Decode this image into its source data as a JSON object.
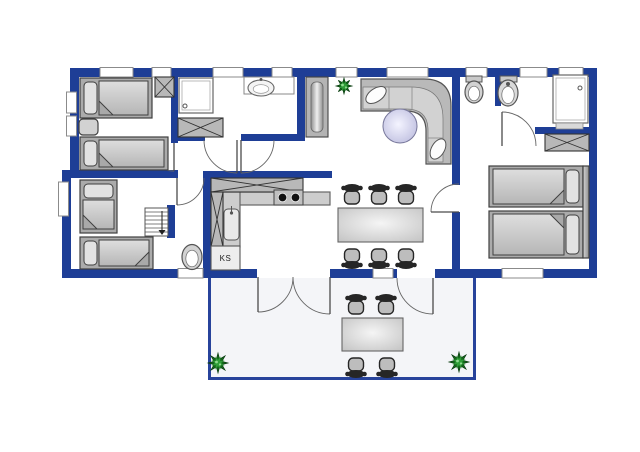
{
  "labels": {
    "fridge": "KS"
  },
  "palette": {
    "wall": "#1e3e96",
    "terraceWall": "#27439b",
    "line": "#3f3f3f",
    "furn": "#ababab",
    "furnLight": "#d2d2d2",
    "pillow": "#e2e2e2",
    "fold": "#a9a9a9",
    "chairDark": "#262626",
    "chairSeat": "#bdbdbd",
    "white": "#ffffff",
    "windowStroke": "#8b8b8b",
    "plantDark": "#14691c",
    "plantMid": "#2f9e38",
    "plantLight": "#8fd98f",
    "terraceFloor": "#f4f5f8",
    "counter": "#cdcdcd",
    "fixture": "#d9d9d9"
  },
  "floor_plan": {
    "canvas": {
      "w": 640,
      "h": 452
    },
    "house_floor": [
      62,
      68,
      535,
      210
    ],
    "walls": [
      {
        "n": "top-wall",
        "x": 70,
        "y": 68,
        "w": 527,
        "h": 9
      },
      {
        "n": "bottom-wall-left",
        "x": 62,
        "y": 269,
        "w": 195,
        "h": 9
      },
      {
        "n": "bottom-wall-mid",
        "x": 330,
        "y": 269,
        "w": 67,
        "h": 9
      },
      {
        "n": "bottom-wall-right",
        "x": 435,
        "y": 269,
        "w": 162,
        "h": 9
      },
      {
        "n": "left-wall-upper",
        "x": 70,
        "y": 68,
        "w": 9,
        "h": 108
      },
      {
        "n": "left-wall-lower",
        "x": 62,
        "y": 170,
        "w": 9,
        "h": 108
      },
      {
        "n": "right-wall",
        "x": 589,
        "y": 68,
        "w": 8,
        "h": 210
      },
      {
        "n": "bedroom1-bedroom2-wall",
        "x": 62,
        "y": 170,
        "w": 116,
        "h": 8
      },
      {
        "n": "bedroom1-hall-wall",
        "x": 171,
        "y": 68,
        "w": 7,
        "h": 75
      },
      {
        "n": "bathroom1-hall-wall-left",
        "x": 171,
        "y": 134,
        "w": 34,
        "h": 7
      },
      {
        "n": "bathroom1-hall-wall-right",
        "x": 241,
        "y": 134,
        "w": 64,
        "h": 7
      },
      {
        "n": "bathroom1-living-wall",
        "x": 297,
        "y": 68,
        "w": 8,
        "h": 73
      },
      {
        "n": "kitchen-top-wall",
        "x": 203,
        "y": 171,
        "w": 129,
        "h": 7
      },
      {
        "n": "corridor-kitchen-wall",
        "x": 203,
        "y": 171,
        "w": 8,
        "h": 107
      },
      {
        "n": "stairs-stub-wall",
        "x": 167,
        "y": 205,
        "w": 8,
        "h": 33
      },
      {
        "n": "living-bathroom2-wall",
        "x": 452,
        "y": 68,
        "w": 8,
        "h": 117
      },
      {
        "n": "dining-bedroom3-wall",
        "x": 452,
        "y": 212,
        "w": 8,
        "h": 66
      },
      {
        "n": "bathroom2-stub-wall",
        "x": 495,
        "y": 68,
        "w": 6,
        "h": 38
      },
      {
        "n": "bathroom2-bedroom3-wall",
        "x": 535,
        "y": 127,
        "w": 55,
        "h": 7
      }
    ],
    "windows": [
      {
        "n": "window-top-1",
        "x": 100,
        "y": 67.5,
        "w": 33,
        "h": 9.5
      },
      {
        "n": "window-top-2",
        "x": 152,
        "y": 67.5,
        "w": 19,
        "h": 9.5
      },
      {
        "n": "window-top-3",
        "x": 213,
        "y": 67.5,
        "w": 30,
        "h": 9.5
      },
      {
        "n": "window-top-4",
        "x": 272,
        "y": 67.5,
        "w": 20,
        "h": 9.5
      },
      {
        "n": "window-top-5",
        "x": 336,
        "y": 67.5,
        "w": 21,
        "h": 9.5
      },
      {
        "n": "window-top-6",
        "x": 387,
        "y": 67.5,
        "w": 41,
        "h": 9.5
      },
      {
        "n": "window-top-7",
        "x": 466,
        "y": 67.5,
        "w": 21,
        "h": 9.5
      },
      {
        "n": "window-top-8",
        "x": 520,
        "y": 67.5,
        "w": 27,
        "h": 9.5
      },
      {
        "n": "window-top-9",
        "x": 559,
        "y": 67.5,
        "w": 24,
        "h": 9.5
      },
      {
        "n": "window-left-1",
        "x": 66.5,
        "y": 92,
        "w": 10,
        "h": 21
      },
      {
        "n": "window-left-2",
        "x": 66.5,
        "y": 116,
        "w": 10,
        "h": 20
      },
      {
        "n": "window-left-3",
        "x": 58.5,
        "y": 182,
        "w": 10,
        "h": 34
      },
      {
        "n": "window-bottom-1",
        "x": 178,
        "y": 268.5,
        "w": 25,
        "h": 9.5
      },
      {
        "n": "window-bottom-2",
        "x": 373,
        "y": 268.5,
        "w": 20,
        "h": 9.5
      },
      {
        "n": "window-bottom-3",
        "x": 502,
        "y": 268.5,
        "w": 41,
        "h": 9.5
      }
    ],
    "doors": [
      {
        "n": "bedroom1-door",
        "hx": 174,
        "hy": 143,
        "r": 28,
        "a0": 180,
        "a1": 90
      },
      {
        "n": "bedroom2-door",
        "hx": 177,
        "hy": 178,
        "r": 27,
        "a0": 0,
        "a1": 90
      },
      {
        "n": "bathroom1-door",
        "hx": 237,
        "hy": 140,
        "r": 33,
        "a0": 180,
        "a1": 90
      },
      {
        "n": "hall-kitchen-door",
        "hx": 241,
        "hy": 140,
        "r": 33,
        "a0": 0,
        "a1": 90
      },
      {
        "n": "bedroom3-door",
        "hx": 459,
        "hy": 212,
        "r": 28,
        "a0": 270,
        "a1": 180
      },
      {
        "n": "bathroom2-door",
        "hx": 502,
        "hy": 146,
        "r": 34,
        "a0": 360,
        "a1": 270
      },
      {
        "n": "terrace-french-door-left",
        "hx": 258,
        "hy": 277,
        "r": 35,
        "a0": 0,
        "a1": 90
      },
      {
        "n": "terrace-french-door-right",
        "hx": 330,
        "hy": 277,
        "r": 37,
        "a0": 180,
        "a1": 90
      },
      {
        "n": "terrace-side-door",
        "hx": 433,
        "hy": 278,
        "r": 36,
        "a0": 180,
        "a1": 90
      }
    ],
    "terrace": {
      "floor": [
        208,
        278,
        268,
        102
      ],
      "walls": [
        [
          208,
          278,
          3,
          102
        ],
        [
          473,
          278,
          3,
          102
        ],
        [
          208,
          377,
          268,
          3
        ]
      ]
    },
    "beds": [
      {
        "n": "bedroom1-bed-upper",
        "x": 80,
        "y": 78,
        "w": 72,
        "h": 40,
        "dir": "left",
        "fold": "bl"
      },
      {
        "n": "bedroom1-bed-lower",
        "x": 80,
        "y": 137,
        "w": 88,
        "h": 33,
        "dir": "left",
        "fold": "bl"
      },
      {
        "n": "bedroom2-bed-vertical",
        "x": 80,
        "y": 180,
        "w": 37,
        "h": 53,
        "dir": "top",
        "fold": "bl"
      },
      {
        "n": "bedroom2-bed-horizontal",
        "x": 80,
        "y": 237,
        "w": 73,
        "h": 32,
        "dir": "left",
        "fold": "br"
      },
      {
        "n": "bedroom3-bed-upper",
        "x": 489,
        "y": 166,
        "w": 94,
        "h": 41,
        "dir": "right",
        "fold": "br"
      },
      {
        "n": "bedroom3-bed-lower",
        "x": 489,
        "y": 211,
        "w": 94,
        "h": 47,
        "dir": "right",
        "fold": "tr"
      }
    ],
    "counters": [
      {
        "n": "kitchen-counter-top",
        "x": 211,
        "y": 192,
        "w": 119,
        "h": 13
      },
      {
        "n": "kitchen-counter-side",
        "x": 222,
        "y": 192,
        "w": 18,
        "h": 55
      }
    ],
    "xboxes": [
      {
        "n": "bedroom1-wardrobe",
        "x": 155,
        "y": 77,
        "w": 19,
        "h": 20
      },
      {
        "n": "bathroom1-wardrobe",
        "x": 178,
        "y": 118,
        "w": 45,
        "h": 19
      },
      {
        "n": "bedroom3-wardrobe",
        "x": 545,
        "y": 134,
        "w": 44,
        "h": 17
      },
      {
        "n": "kitchen-upper-cabinet",
        "x": 211,
        "y": 178,
        "w": 92,
        "h": 14
      },
      {
        "n": "kitchen-side-cabinet",
        "x": 211,
        "y": 192,
        "w": 12,
        "h": 55
      }
    ],
    "stove": {
      "x": 274,
      "y": 190,
      "w": 29,
      "h": 15,
      "burners": [
        [
          282.5,
          197.5
        ],
        [
          295.5,
          197.5
        ]
      ],
      "burnerR": 4.3
    },
    "sink": {
      "x": 224,
      "y": 209,
      "w": 15,
      "h": 31
    },
    "fridge": {
      "x": 211,
      "y": 246,
      "w": 29,
      "h": 24
    },
    "nightstand": {
      "x": 79,
      "y": 119,
      "w": 19,
      "h": 16
    },
    "stairs": {
      "x": 145,
      "y": 208,
      "w": 23,
      "h": 28,
      "steps": 6
    },
    "headboard": {
      "x": 583,
      "y": 166,
      "w": 6,
      "h": 92
    },
    "tall_cabinet": {
      "x": 306,
      "y": 77,
      "w": 22,
      "h": 60
    },
    "sofa": {
      "base": "M361,79 L424,79 Q451,79 451,106 L451,164 L426,164 L426,131 Q426,111 406,111 L361,111 Z",
      "seat": "M363,87 L411,87 Q443,87 443,119 L443,162 L428,162 L428,130 Q428,109 406,109 L363,109 Z",
      "dividers": [
        [
          389,
          87,
          389,
          109
        ],
        [
          412,
          87,
          412,
          109
        ],
        [
          428,
          138,
          443,
          138
        ]
      ],
      "pillows": [
        {
          "cx": 376,
          "cy": 95,
          "rx": 11.5,
          "ry": 6.5,
          "rot": -35
        },
        {
          "cx": 438,
          "cy": 149,
          "rx": 11,
          "ry": 6.5,
          "rot": -60
        }
      ]
    },
    "orb_table": {
      "cx": 400,
      "cy": 126,
      "r": 17
    },
    "dining_table": {
      "x": 338,
      "y": 208,
      "w": 85,
      "h": 34
    },
    "terrace_table": {
      "x": 342,
      "y": 318,
      "w": 61,
      "h": 33
    },
    "chairs": [
      {
        "n": "dining-chair-1",
        "x": 352,
        "y": 196,
        "flip": false
      },
      {
        "n": "dining-chair-2",
        "x": 379,
        "y": 196,
        "flip": false
      },
      {
        "n": "dining-chair-3",
        "x": 406,
        "y": 196,
        "flip": false
      },
      {
        "n": "dining-chair-4",
        "x": 352,
        "y": 257,
        "flip": true
      },
      {
        "n": "dining-chair-5",
        "x": 379,
        "y": 257,
        "flip": true
      },
      {
        "n": "dining-chair-6",
        "x": 406,
        "y": 257,
        "flip": true
      },
      {
        "n": "terrace-chair-1",
        "x": 356,
        "y": 306,
        "flip": false
      },
      {
        "n": "terrace-chair-2",
        "x": 386,
        "y": 306,
        "flip": false
      },
      {
        "n": "terrace-chair-3",
        "x": 356,
        "y": 366,
        "flip": true
      },
      {
        "n": "terrace-chair-4",
        "x": 387,
        "y": 366,
        "flip": true
      }
    ],
    "toilets": [
      {
        "n": "wc-toilet",
        "cx": 192,
        "cy": 257,
        "rx": 10,
        "ry": 12.5
      },
      {
        "n": "bathroom2-toilet",
        "cx": 474,
        "cy": 92,
        "rx": 9,
        "ry": 11,
        "tank": [
          466,
          76,
          16,
          6
        ]
      }
    ],
    "basin2": {
      "cx": 508,
      "cy": 93,
      "rx": 10,
      "ry": 13,
      "tank": [
        500,
        76,
        17,
        6
      ]
    },
    "vanity1": {
      "x": 244,
      "y": 77,
      "w": 50,
      "h": 17,
      "basin": [
        261,
        88,
        13,
        8
      ]
    },
    "showers": [
      {
        "n": "bathroom1-shower",
        "x": 179,
        "y": 78,
        "w": 34,
        "h": 35,
        "drain": [
          185,
          106
        ]
      },
      {
        "n": "bathroom2-shower",
        "x": 553,
        "y": 75,
        "w": 35,
        "h": 48,
        "drain": [
          580,
          88
        ],
        "mat": [
          556,
          123,
          27,
          6
        ]
      }
    ],
    "plants": [
      {
        "n": "living-room-plant",
        "cx": 344,
        "cy": 86,
        "r": 8
      },
      {
        "n": "terrace-plant-left",
        "cx": 218,
        "cy": 363,
        "r": 10
      },
      {
        "n": "terrace-plant-right",
        "cx": 459,
        "cy": 362,
        "r": 10
      }
    ]
  }
}
